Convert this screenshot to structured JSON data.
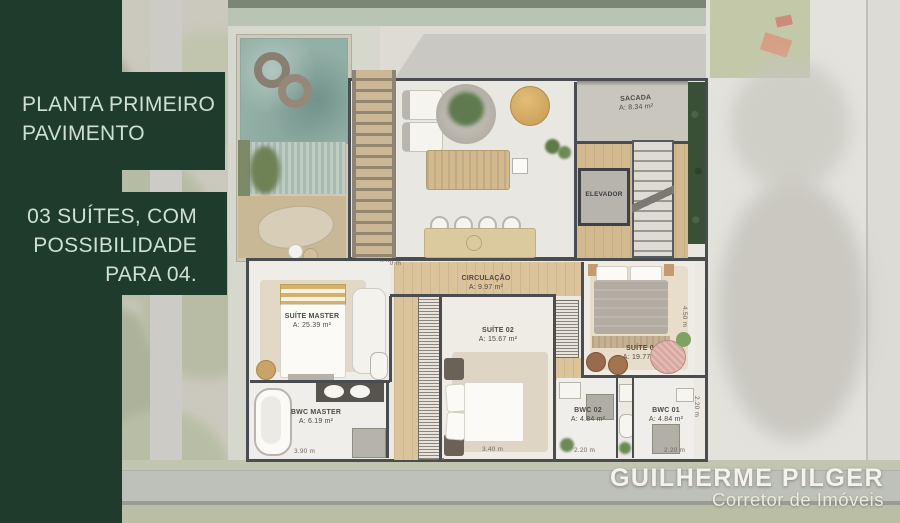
{
  "panel": {
    "title": "PLANTA PRIMEIRO PAVIMENTO",
    "subtitle": "03 SUÍTES, COM POSSIBILIDADE PARA 04.",
    "bg_color": "#1e3b2b",
    "text_color": "#cfe0d3"
  },
  "branding": {
    "name": "GUILHERME PILGER",
    "role": "Corretor de Imóveis"
  },
  "rooms": {
    "sacada": {
      "name": "SACADA",
      "area": "A: 8.34 m²"
    },
    "elevador": {
      "name": "ELEVADOR"
    },
    "circulacao": {
      "name": "CIRCULAÇÃO",
      "area": "A: 9.97 m²"
    },
    "suite_master": {
      "name": "SUÍTE MASTER",
      "area": "A: 25.39 m²"
    },
    "suite_02": {
      "name": "SUÍTE 02",
      "area": "A: 15.67 m²"
    },
    "suite_01": {
      "name": "SUÍTE 01",
      "area": "A: 19.77 m²"
    },
    "bwc_master": {
      "name": "BWC MASTER",
      "area": "A: 6.19 m²"
    },
    "bwc_02": {
      "name": "BWC 02",
      "area": "A: 4.84 m²"
    },
    "bwc_01": {
      "name": "BWC 01",
      "area": "A: 4.84 m²"
    }
  },
  "dimensions": {
    "corridor_top": "3.20 m",
    "bwc_master_w": "3.90 m",
    "suite_02_w": "3.40 m",
    "bwc_02_w": "2.20 m",
    "bwc_01_w": "2.20 m",
    "suite_01_h": "4.50 m",
    "bwc_01_h": "2.20 m"
  },
  "colors": {
    "pool_water": "#93b0a7",
    "hedge": "#3a5036",
    "wood_floor": "#dbc49c",
    "wall": "#4a4d50"
  }
}
